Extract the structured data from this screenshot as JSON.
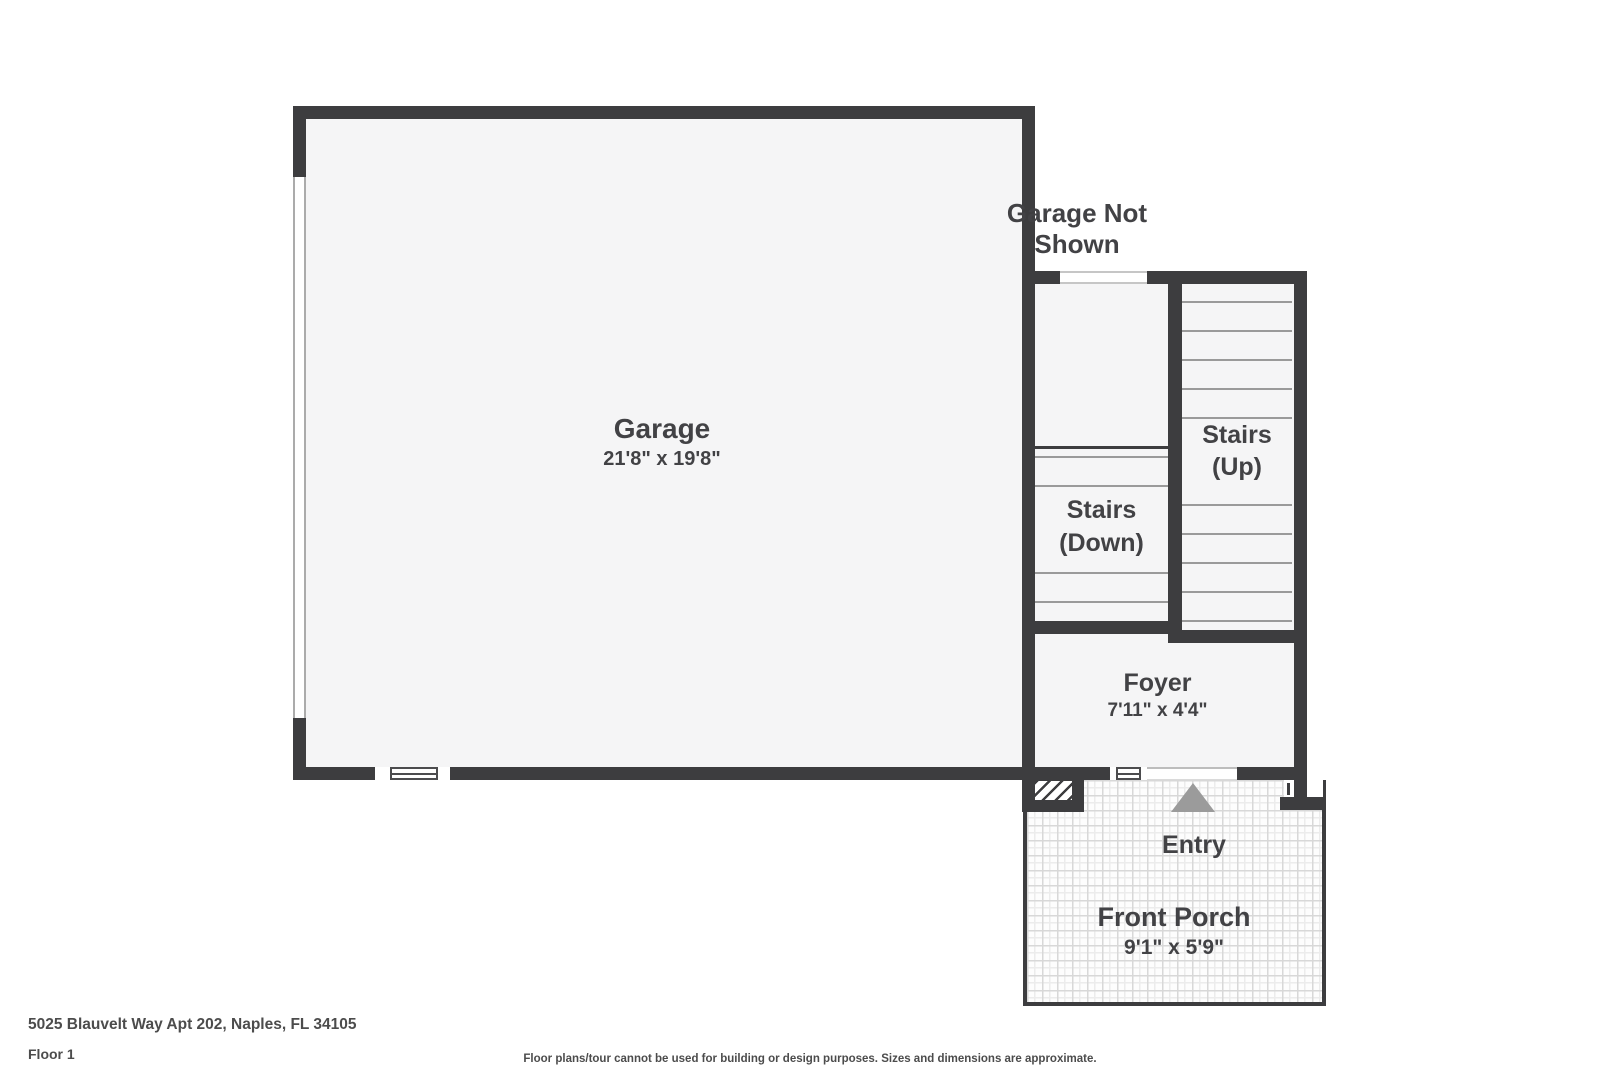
{
  "plan": {
    "garage": {
      "name": "Garage",
      "dims": "21'8\" x 19'8\""
    },
    "garage_not_shown": {
      "line1": "Garage Not",
      "line2": "Shown"
    },
    "stairs_up": {
      "line1": "Stairs",
      "line2": "(Up)"
    },
    "stairs_down": {
      "line1": "Stairs",
      "line2": "(Down)"
    },
    "foyer": {
      "name": "Foyer",
      "dims": "7'11\" x 4'4\""
    },
    "entry": {
      "label": "Entry"
    },
    "front_porch": {
      "name": "Front Porch",
      "dims": "9'1\" x 5'9\""
    }
  },
  "footer": {
    "address": "5025 Blauvelt Way Apt 202, Naples, FL 34105",
    "floor_label": "Floor 1",
    "disclaimer": "Floor plans/tour cannot be used for building or design purposes. Sizes and dimensions are approximate."
  },
  "colors": {
    "wall": "#3d3d3f",
    "room_fill": "#f5f5f6",
    "label_text": "#424245",
    "tread_line": "#9a9a9a",
    "entry_arrow": "#9b9b9b",
    "tile_line": "#d8d8d8"
  }
}
